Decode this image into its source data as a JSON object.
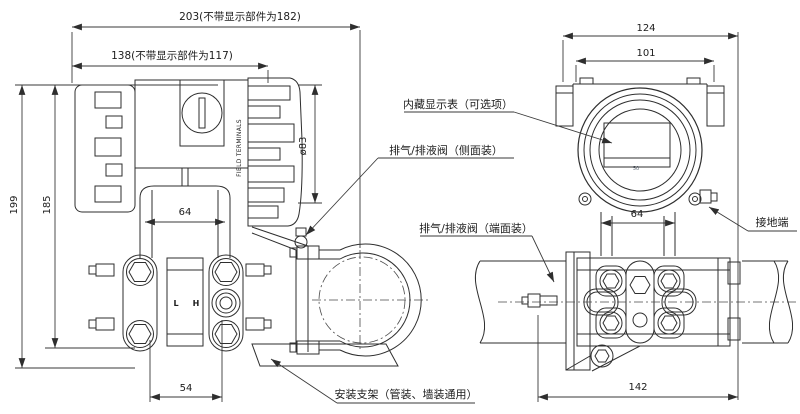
{
  "page": {
    "background": "#ffffff"
  },
  "dims": {
    "total_length": "203(不带显示部件为182)",
    "body_length": "138(不带显示部件为117)",
    "overall_height": "199",
    "body_height": "185",
    "cover_dia": "ø83",
    "neck_width_side": "64",
    "port_spacing": "54",
    "front_overall_width": "124",
    "front_housing_width": "101",
    "front_neck_width": "64",
    "manifold_width": "142"
  },
  "callouts": {
    "builtin_display": "内藏显示表（可选项）",
    "vent_side": "排气/排液阀（侧面装）",
    "vent_end": "排气/排液阀（端面装）",
    "bracket": "安装支架（管装、墙装通用）",
    "ground_terminal": "接地端"
  },
  "part_labels": {
    "field_terminals": "FIELD TERMINALS",
    "low": "L",
    "high": "H",
    "display_scale": "50"
  }
}
